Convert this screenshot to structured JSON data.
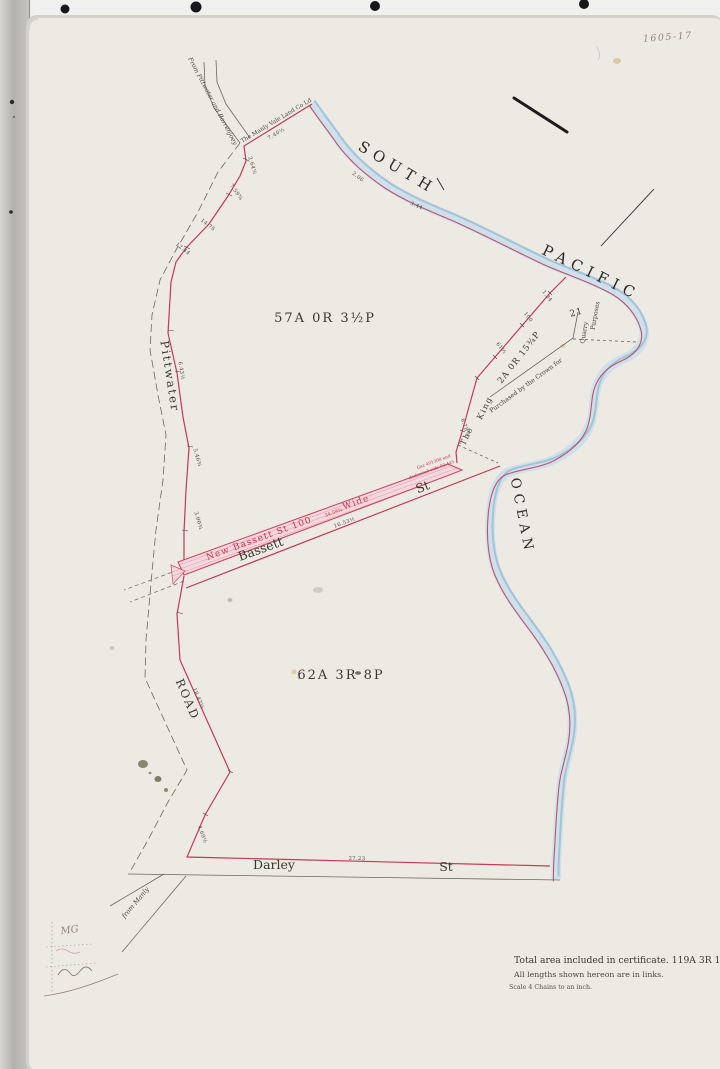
{
  "archive_number": "1605-17",
  "ocean": {
    "south": "SOUTH",
    "pacific": "PACIFIC",
    "ocean": "OCEAN"
  },
  "parcels": {
    "main_north": {
      "area": "57A    0R    3½P"
    },
    "main_south": {
      "area": "62A     3R     8P"
    },
    "quarry": {
      "area": "2A  0R  15¾P",
      "lot": "21",
      "owner_word1": "The",
      "owner_word2": "King",
      "note_diag": "Purchased  by  the  Crown  for",
      "note_v1": "Quarry",
      "note_v2": "Purposes"
    }
  },
  "roads": {
    "pittwater": "Pittwater",
    "road": "ROAD",
    "bassett": "Bassett",
    "bassett_st": "St",
    "new_bassett": "New  Bassett  St  100",
    "new_bassett_length": "34.59¾",
    "new_bassett_wide": "Wide",
    "new_bassett_dedication_1": "Gaz 401308 and",
    "new_bassett_dedication_2": "dedicated vide 93.445",
    "darley": "Darley",
    "darley_st": "St",
    "from_pittwater": "From Pittwater and Barrenjoey",
    "from_manly": "from Manly",
    "manly_vale_boundary": "The Manly Vale Land Co Ld"
  },
  "notes": {
    "total_area": "Total area included in certificate. 119A  3R  11½P",
    "lengths": "All lengths shown hereon are in links.",
    "scale": "Scale 4 Chains  to an inch."
  },
  "handwriting": {
    "initials": "MG"
  },
  "measurements": [
    {
      "name": "meas-manly-vale",
      "text": "7.40½",
      "x": 277,
      "y": 135,
      "rot": -31
    },
    {
      "name": "meas-west-1",
      "text": "2.64½",
      "x": 251,
      "y": 166,
      "rot": 73
    },
    {
      "name": "meas-west-2",
      "text": "7.59¾",
      "x": 235,
      "y": 193,
      "rot": 55
    },
    {
      "name": "meas-west-3",
      "text": "14.76",
      "x": 207,
      "y": 226,
      "rot": 38
    },
    {
      "name": "meas-west-4",
      "text": "12.44",
      "x": 182,
      "y": 250,
      "rot": 38
    },
    {
      "name": "meas-pittwater",
      "text": "6.43½",
      "x": 180,
      "y": 371,
      "rot": 81
    },
    {
      "name": "meas-west-5",
      "text": "5.46¾",
      "x": 196,
      "y": 458,
      "rot": 74
    },
    {
      "name": "meas-west-6",
      "text": "3.00¾",
      "x": 197,
      "y": 521,
      "rot": 74
    },
    {
      "name": "meas-bassett",
      "text": "16.53½",
      "x": 345,
      "y": 524,
      "rot": -20
    },
    {
      "name": "meas-king-1",
      "text": "1.34",
      "x": 546,
      "y": 297,
      "rot": 52
    },
    {
      "name": "meas-king-2",
      "text": "100",
      "x": 527,
      "y": 318,
      "rot": 52
    },
    {
      "name": "meas-king-3",
      "text": "61½",
      "x": 500,
      "y": 349,
      "rot": 52
    },
    {
      "name": "meas-king-4",
      "text": "6.78¾",
      "x": 464,
      "y": 428,
      "rot": 70
    },
    {
      "name": "meas-road",
      "text": "18.47½",
      "x": 197,
      "y": 699,
      "rot": 67
    },
    {
      "name": "meas-darley-west",
      "text": "4.69½",
      "x": 201,
      "y": 835,
      "rot": 70
    },
    {
      "name": "meas-darley",
      "text": "27.23",
      "x": 357,
      "y": 860,
      "rot": 1
    },
    {
      "name": "meas-coast-1",
      "text": "2.06",
      "x": 357,
      "y": 178,
      "rot": 38
    },
    {
      "name": "meas-coast-2",
      "text": "3.44",
      "x": 416,
      "y": 207,
      "rot": 24
    }
  ],
  "colors": {
    "boundary_red": "#c23a55",
    "water_blue": "#cedfeb",
    "paper": "#edeae3"
  }
}
